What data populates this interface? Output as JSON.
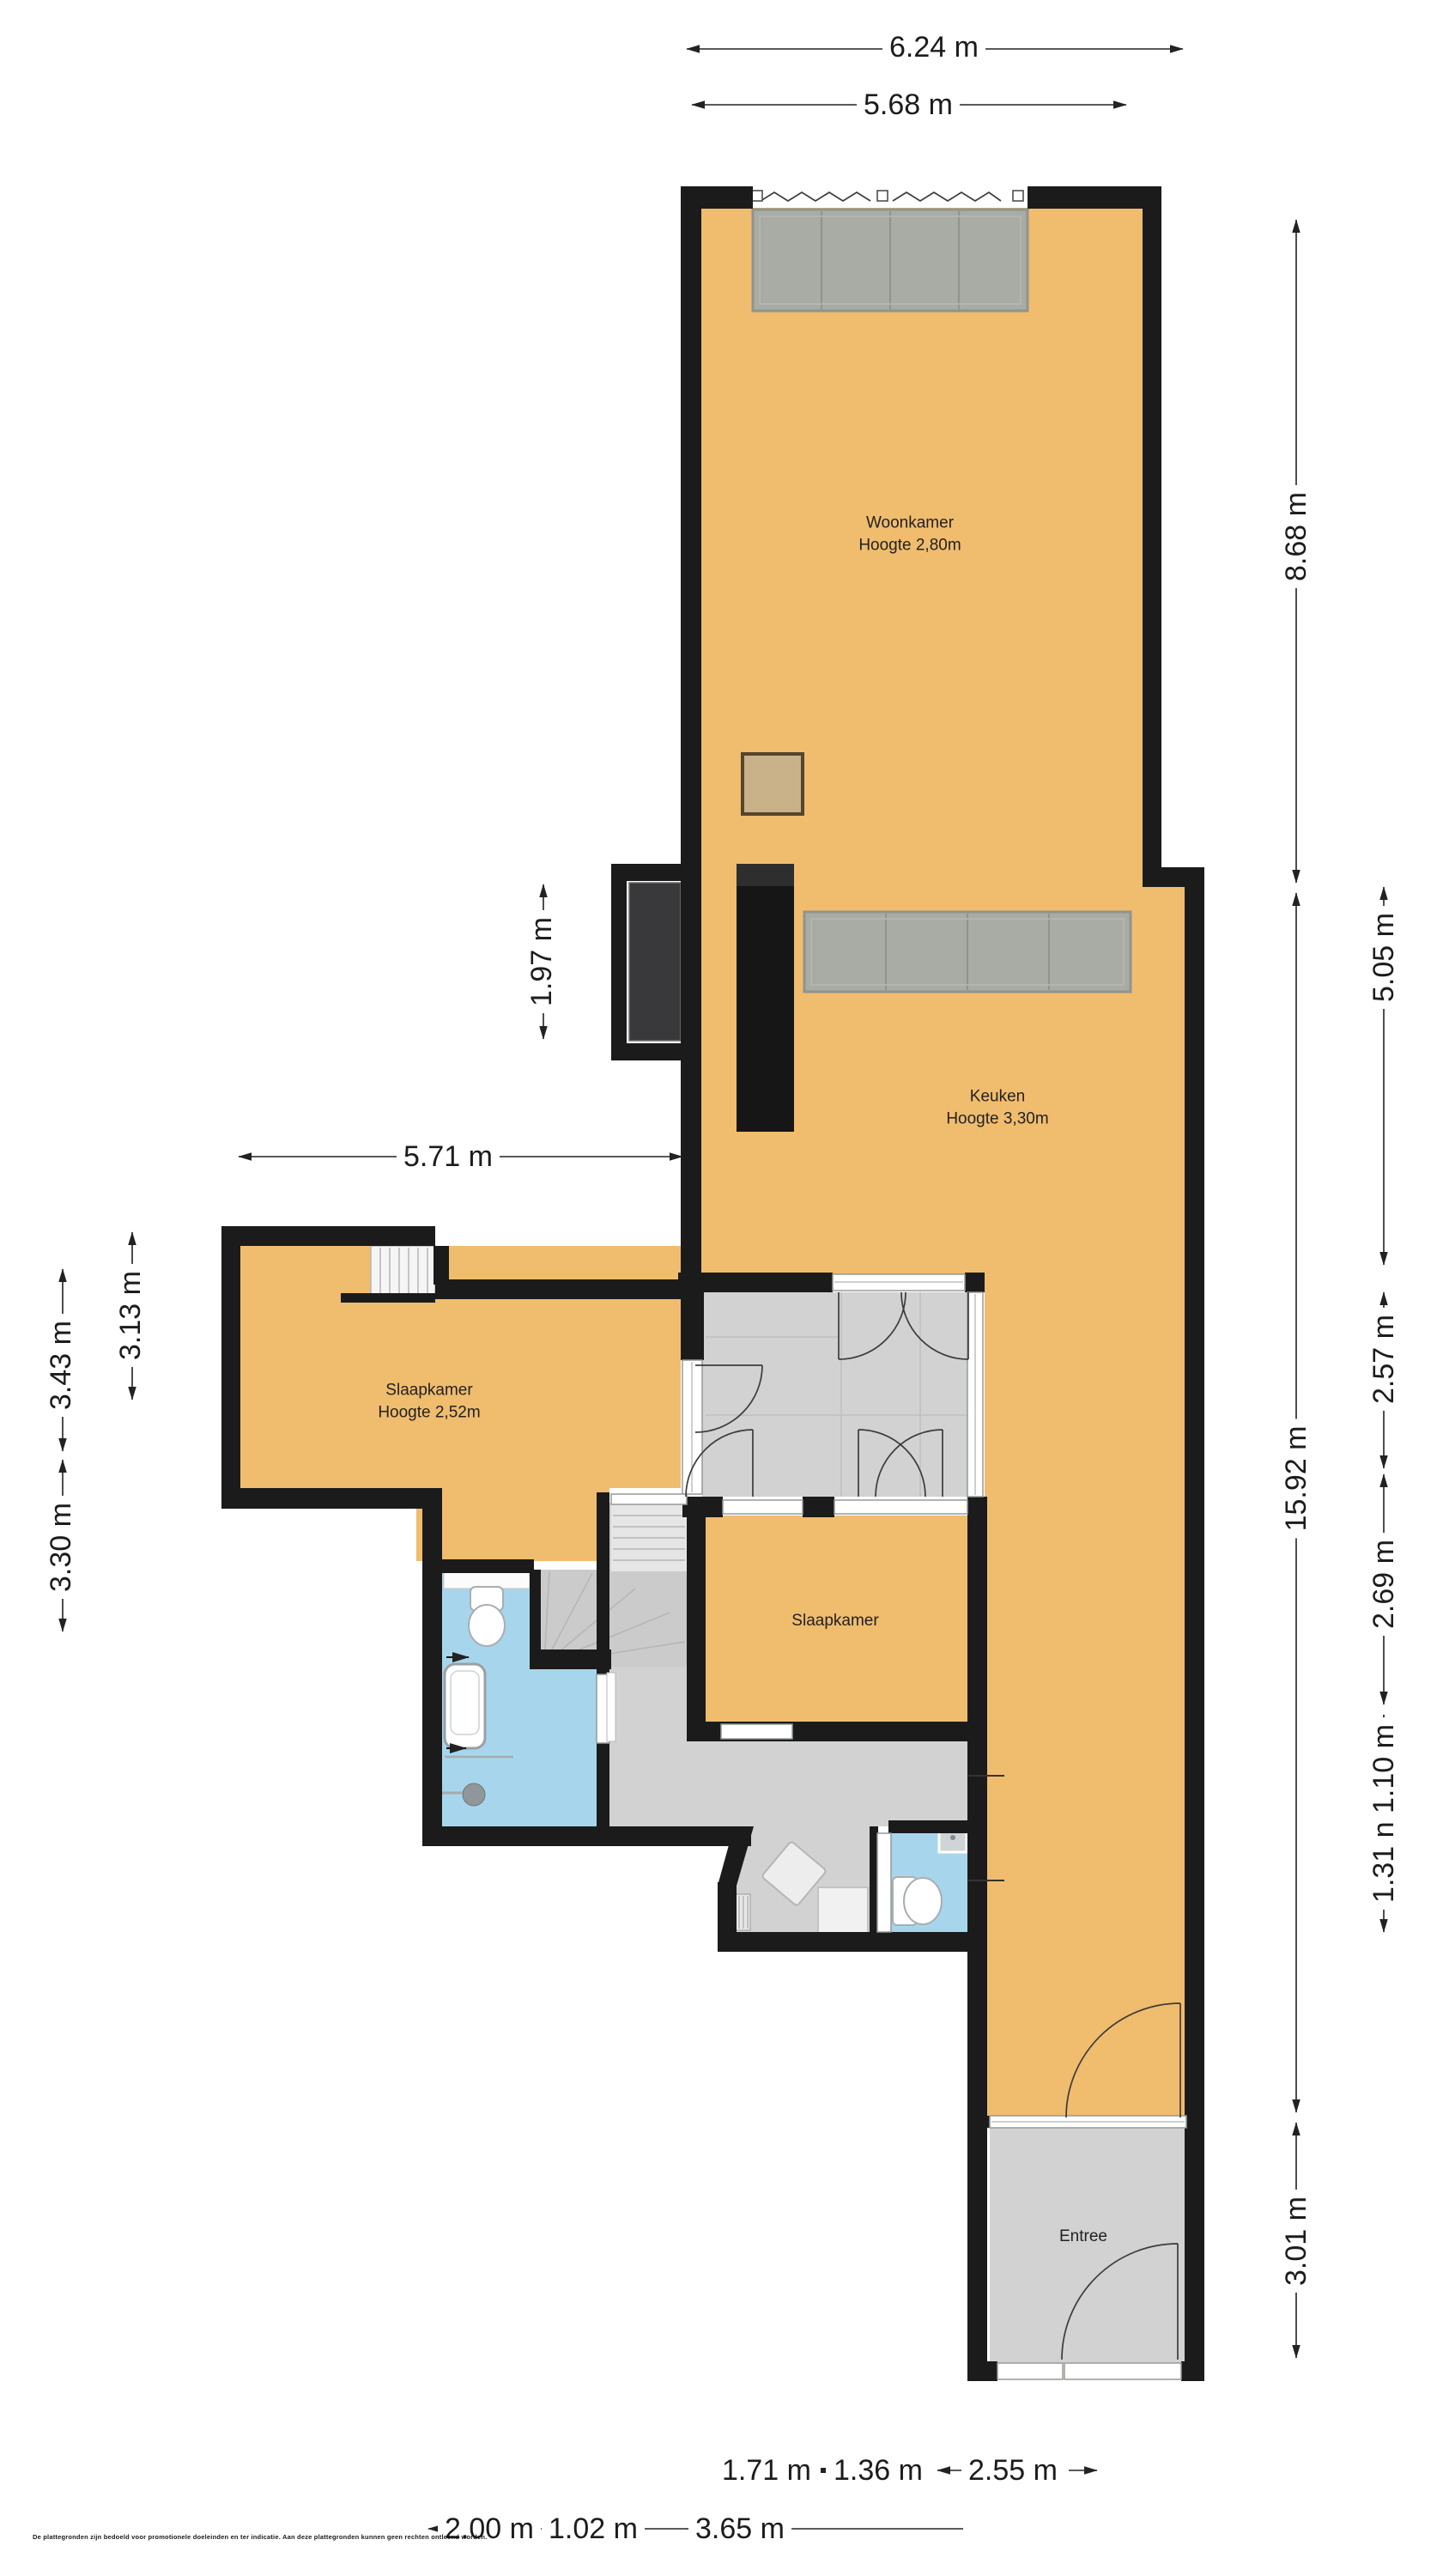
{
  "rooms": {
    "woonkamer": {
      "name": "Woonkamer",
      "height": "Hoogte 2,80m"
    },
    "keuken": {
      "name": "Keuken",
      "height": "Hoogte 3,30m"
    },
    "slaapkamer1": {
      "name": "Slaapkamer",
      "height": "Hoogte 2,52m"
    },
    "slaapkamer2": {
      "name": "Slaapkamer"
    },
    "entree": {
      "name": "Entree"
    }
  },
  "dimensions": {
    "top": {
      "width_outer": "6.24 m",
      "width_inner": "5.68 m"
    },
    "right": {
      "upper": "8.68 m",
      "total": "15.92 m",
      "lower": "3.01 m",
      "kitchen": "5.05 m",
      "hall": "2.57 m",
      "bedroom": "2.69 m",
      "wc": "1.31 n 1.10 m"
    },
    "left": {
      "balcony": "1.97 m",
      "kitchen_width": "5.71 m",
      "bedroom_inner": "3.13 m",
      "bedroom_outer": "3.43 m",
      "bathroom": "3.30 m"
    },
    "bottom": {
      "r1a": "1.71 m",
      "r1b": "1.36 m",
      "r1c": "2.55 m",
      "r2a": "2.00 m",
      "r2b": "1.02 m",
      "r2c": "3.65 m"
    }
  },
  "disclaimer": "De plattegronden zijn bedoeld voor promotionele doeleinden en ter indicatie. Aan deze plattegronden kunnen geen rechten ontleend worden.",
  "colors": {
    "floor_orange": "#f0bc6e",
    "floor_grey": "#d2d2d2",
    "floor_blue": "#a7d6ec",
    "wall_black": "#1b1b1b",
    "glass_grey": "#a9aca4"
  }
}
